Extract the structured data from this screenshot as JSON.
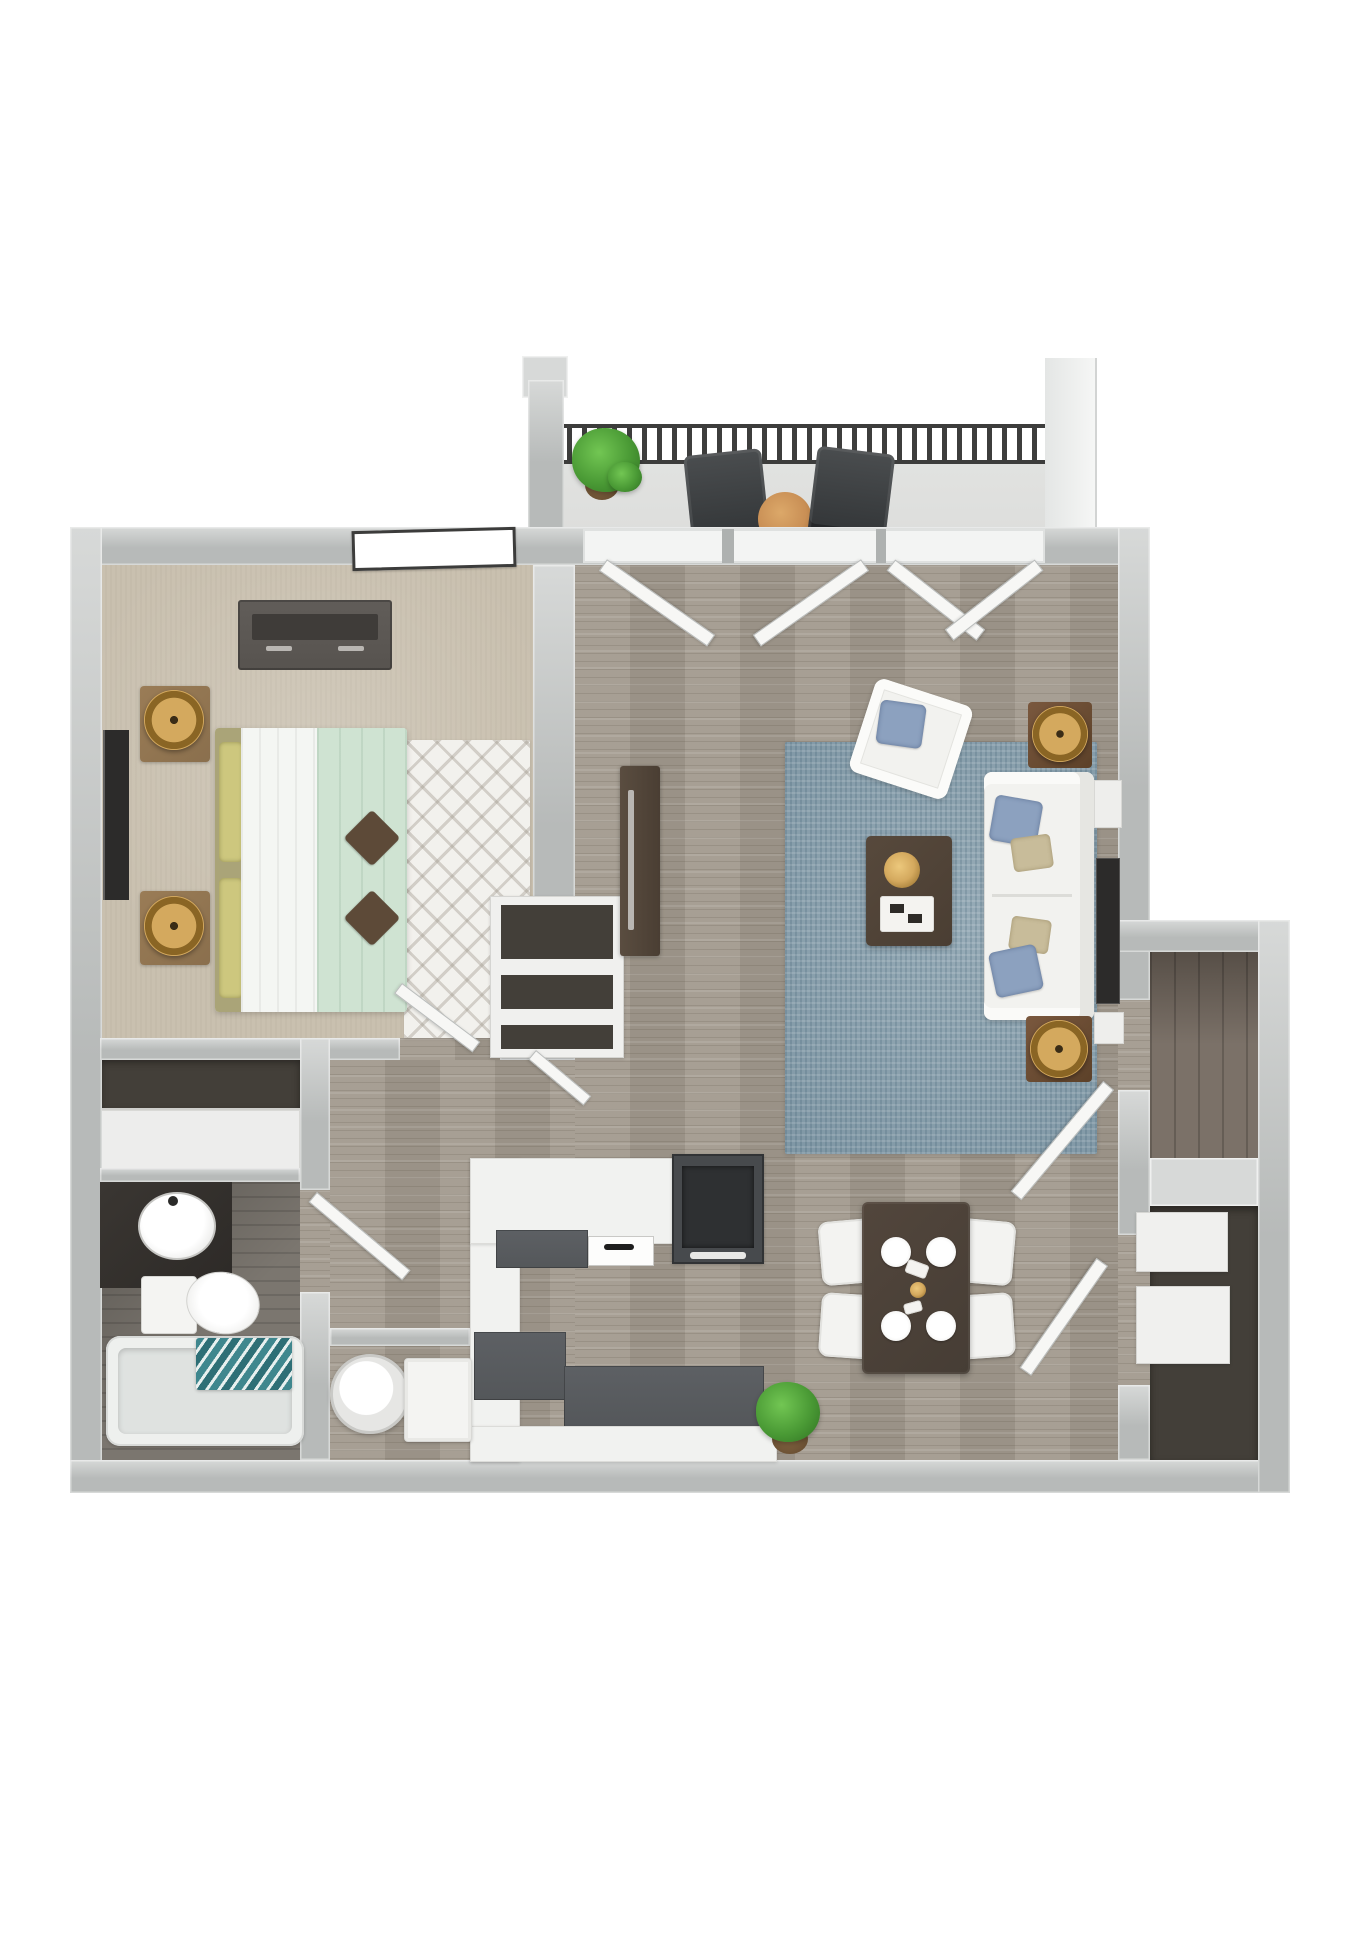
{
  "scene": {
    "kind": "3d-floor-plan-rendering",
    "view": "top-down",
    "unit": "one-bedroom one-bath apartment with balcony"
  },
  "colors": {
    "background": "#ffffff",
    "wall": "#b7bab9",
    "wallLight": "#d7d9d8",
    "wood": "#a29a8e",
    "woodDark": "#7b7168",
    "carpet": "#c9c0af",
    "balconyFloor": "#dbdcda",
    "railing": "#3d3d3c",
    "patioChair": "#3e4143",
    "patioTable": "#c98f55",
    "plant": "#4a9a35",
    "plantDark": "#2f7022",
    "rug": "#8ba2af",
    "sofa": "#f2f2ef",
    "pillowBlue": "#8ca1bf",
    "pillowTan": "#c8bc9a",
    "coffeeTable": "#4a3e33",
    "diningTable": "#463d35",
    "chairWhite": "#f3f3f1",
    "gold": "#d4a95e",
    "goldDark": "#8a6524",
    "woodFurn": "#8a6f4d",
    "dresser": "#57534f",
    "tvDark": "#2c2b2a",
    "bedMint": "#cfe3d2",
    "bedWhite": "#f4f6f3",
    "headboard": "#aaa478",
    "pillowYellow": "#cdc77e",
    "accentPillow": "#5d4a38",
    "counter": "#f1f2f0",
    "counterDark": "#54575a",
    "rangeDark": "#474a4d",
    "cooktop": "#2e3032",
    "bathFloor": "#7b766f",
    "vanity": "#2d2a27",
    "towel": "#3f878e",
    "closetDark": "#433f39",
    "shelfWhite": "#f0f0ee",
    "white": "#f7f7f5"
  },
  "rooms": [
    {
      "name": "balcony",
      "items": [
        "potted-plant",
        "patio-chair",
        "patio-chair",
        "round-patio-table",
        "railing"
      ]
    },
    {
      "name": "living-room",
      "items": [
        "sofa",
        "armchair",
        "coffee-table",
        "area-rug",
        "floor-lamp",
        "floor-lamp",
        "media-console",
        "wall-tv",
        "french-doors"
      ]
    },
    {
      "name": "bedroom",
      "items": [
        "bed",
        "dresser",
        "nightstand",
        "nightstand",
        "table-lamp",
        "table-lamp",
        "wall-tv",
        "chevron-rug",
        "window",
        "door"
      ]
    },
    {
      "name": "bedroom-closet",
      "items": [
        "sliding-door"
      ]
    },
    {
      "name": "bathroom",
      "items": [
        "vanity-sink",
        "toilet",
        "bathtub",
        "towel",
        "door"
      ]
    },
    {
      "name": "hallway",
      "items": [
        "linen-closet",
        "closet-door"
      ]
    },
    {
      "name": "kitchen",
      "items": [
        "u-shaped-counter",
        "range",
        "sink",
        "potted-plant"
      ]
    },
    {
      "name": "dining-area",
      "items": [
        "dining-table",
        "dining-chair",
        "dining-chair",
        "dining-chair",
        "dining-chair",
        "place-setting",
        "place-setting",
        "place-setting",
        "place-setting"
      ]
    },
    {
      "name": "storage-room",
      "items": [
        "door"
      ]
    },
    {
      "name": "entry-closet",
      "items": [
        "shelf",
        "shelf",
        "door"
      ]
    },
    {
      "name": "utility-closet",
      "items": [
        "water-heater",
        "washer"
      ]
    }
  ]
}
